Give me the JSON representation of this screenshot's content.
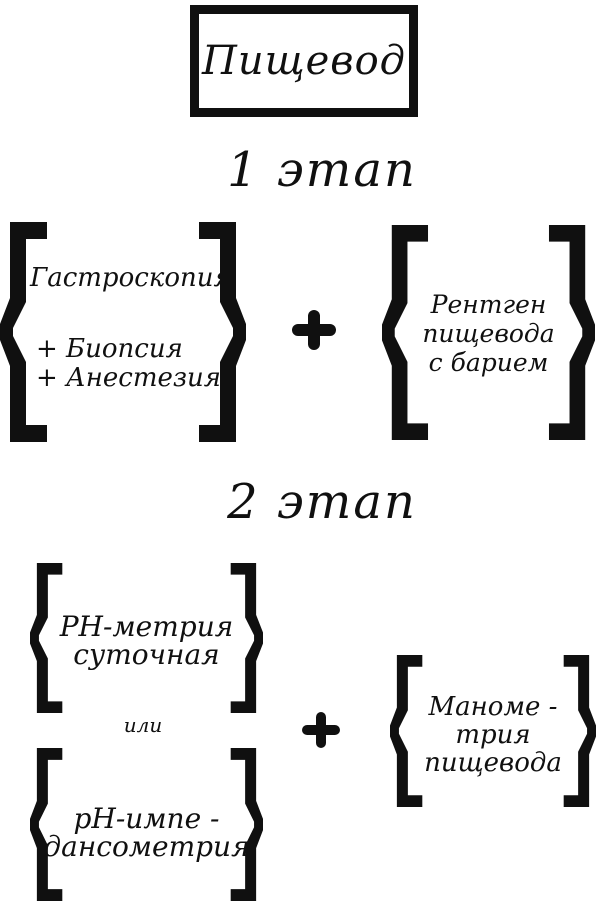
{
  "page": {
    "background_color": "#ffffff",
    "ink_color": "#101010"
  },
  "title_box": {
    "label": "Пищевод"
  },
  "stage1": {
    "heading": "1 этап",
    "left_group": {
      "line1": "Гастроскопия",
      "line2": "+ Биопсия",
      "line3": "+ Анестезия"
    },
    "plus": "+",
    "right_group": {
      "line1": "Рентген",
      "line2": "пищевода",
      "line3": "с барием"
    }
  },
  "stage2": {
    "heading": "2 этап",
    "option_a": {
      "line1": "PH-метрия",
      "line2": "суточная"
    },
    "or_label": "или",
    "option_b": {
      "line1": "pH-импе -",
      "line2": "дансометрия"
    },
    "plus": "+",
    "right_group": {
      "line1": "Маноме -",
      "line2": "трия",
      "line3": "пищевода"
    }
  }
}
